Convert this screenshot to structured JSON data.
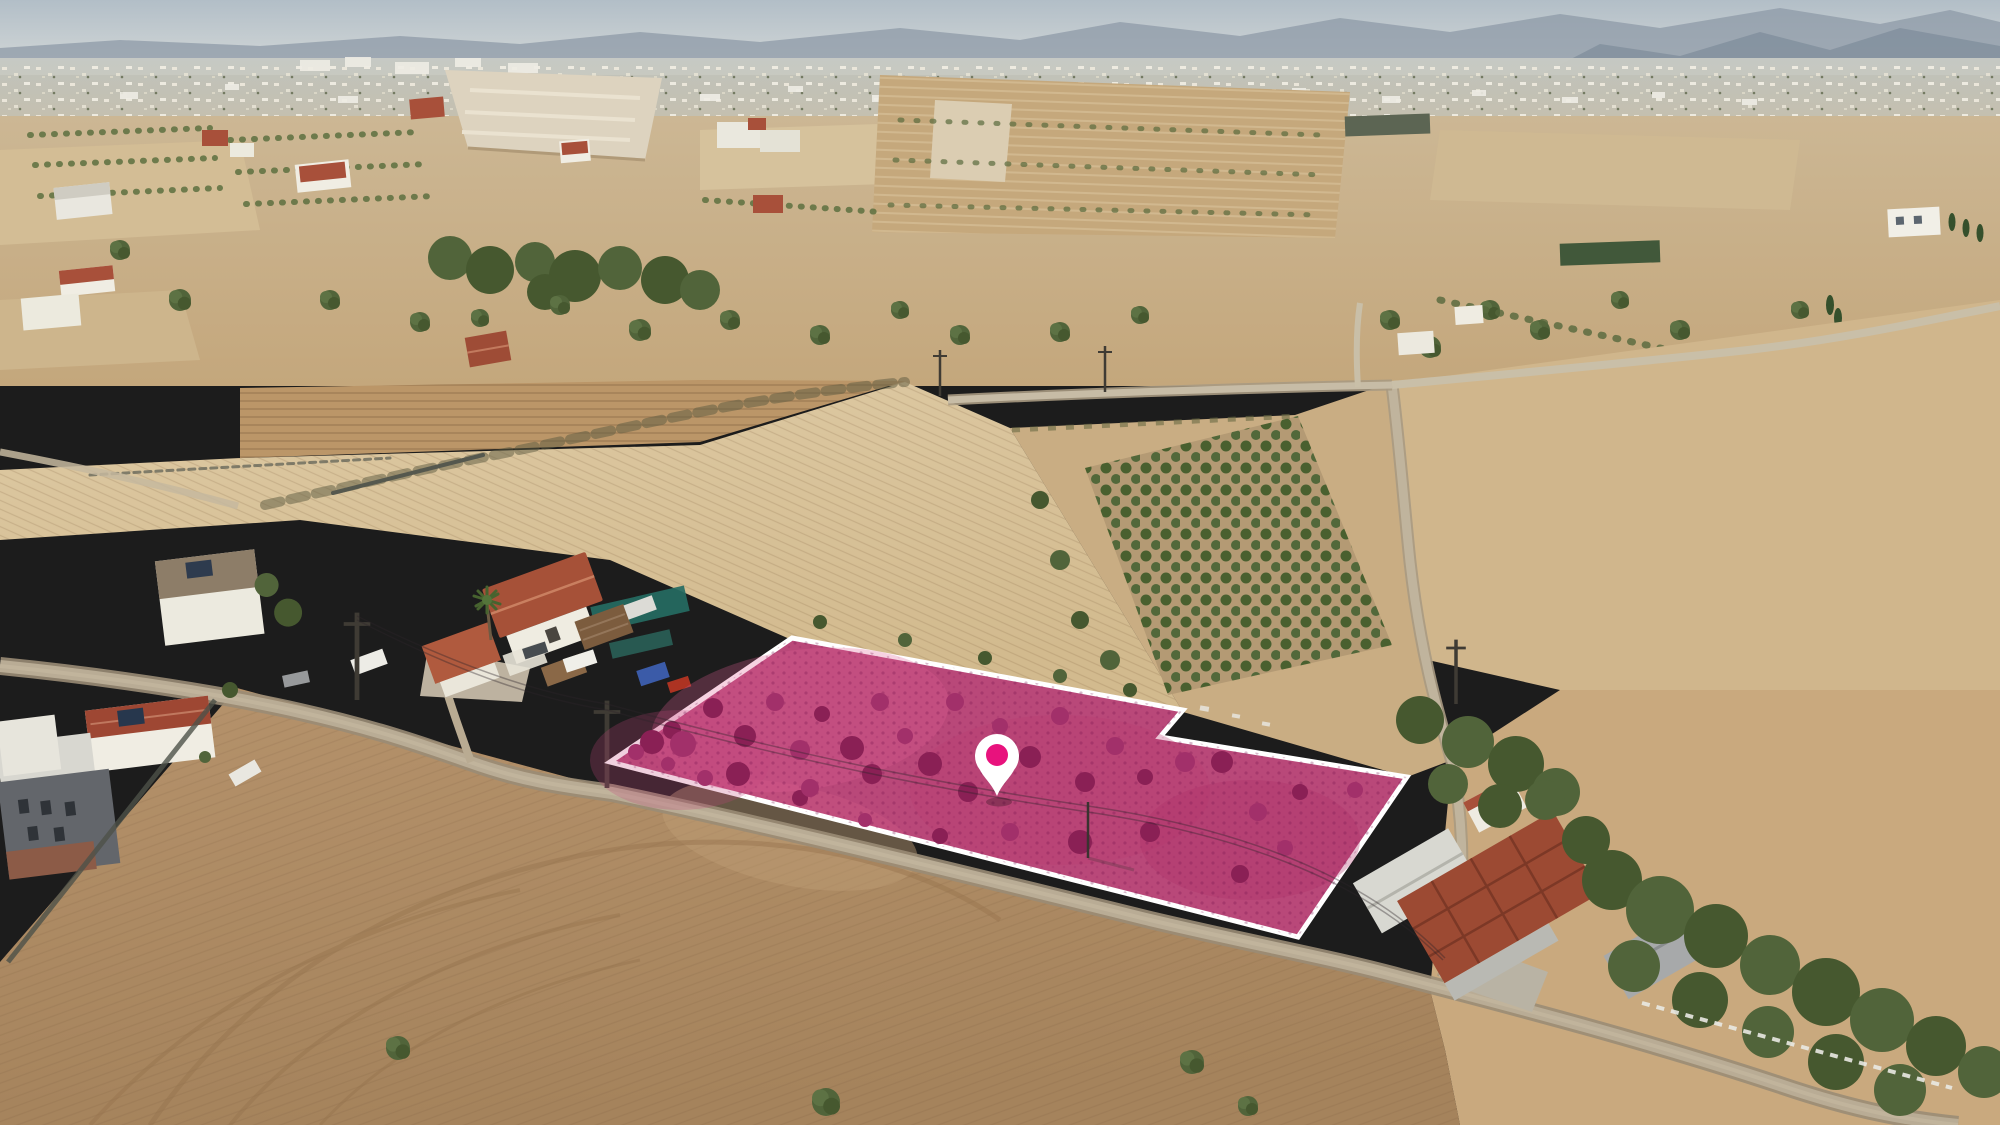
{
  "meta": {
    "type": "aerial-drone-photo",
    "subject": "rural land parcel highlighted for sale listing",
    "visible_text": "none"
  },
  "overlay": {
    "parcel": {
      "points": "792,638 1183,710 1160,737 1407,777 1298,937 610,762",
      "fill": "#cb4e84",
      "fill_opacity": "0.9",
      "stroke": "#ffffff",
      "stroke_width": "5",
      "shrub_dark": "#8a2055",
      "shrub_mid": "#a2306a"
    },
    "pin": {
      "transform": "translate(997,762)",
      "x": 997,
      "y": 762,
      "body": "#ffffff",
      "dot": "#e8127d"
    }
  },
  "palette": {
    "sky": "#b2bec7",
    "mountain": "#8e9aa7",
    "haze": "#c8cbc5",
    "city_white": "#eeeadd",
    "field_straw": "#d8c29a",
    "field_tan": "#c9ad83",
    "field_plow": "#bb9668",
    "field_dirt": "#ad8a64",
    "tree_green": "#51643a",
    "tree_dark": "#46582f",
    "road": "#b9ac95",
    "roof_terracotta": "#a8503a",
    "wall_white": "#f0ede3",
    "tarp_teal": "#256b62",
    "fence_white": "#e9e9e3",
    "quarry": "#ddd3bf"
  }
}
